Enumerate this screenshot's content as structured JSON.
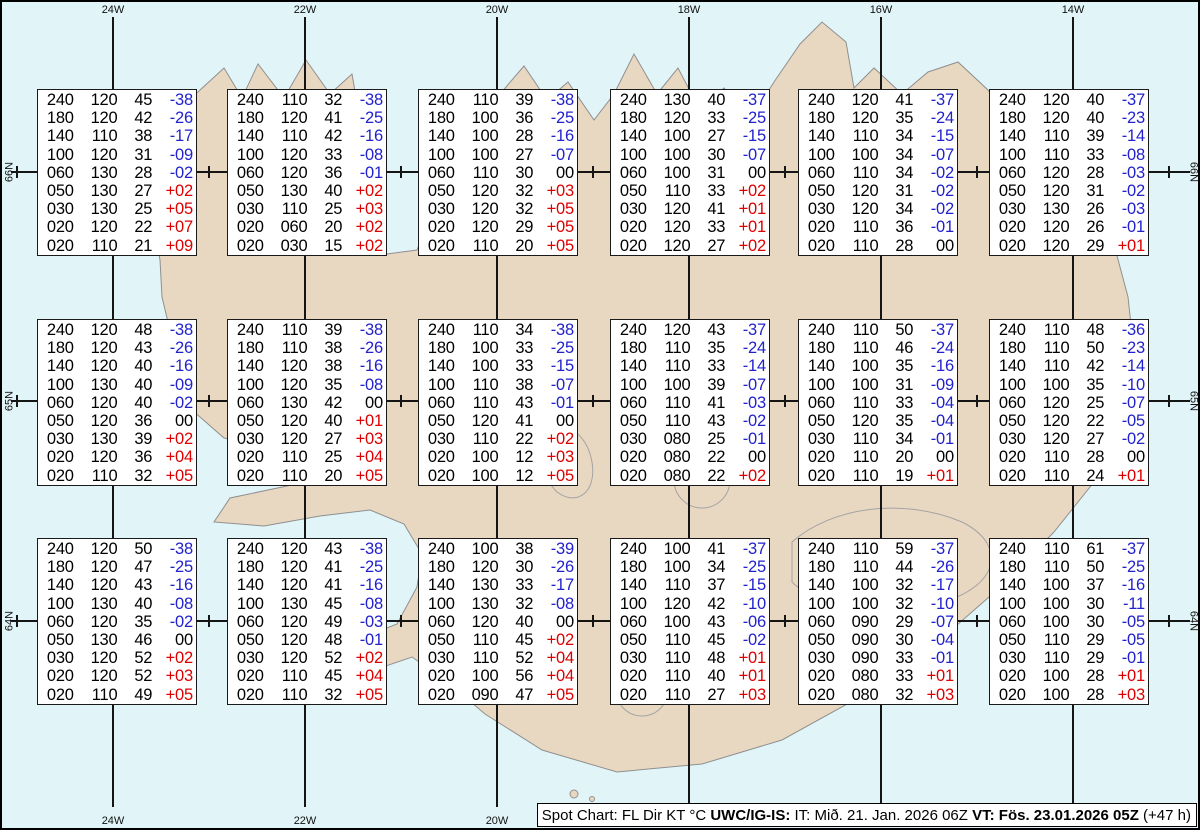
{
  "colors": {
    "water": "#e1f5f9",
    "land": "#e9d8c1",
    "coastline": "#8f8f8f",
    "gridline": "#151515",
    "temp_negative": "#2222cc",
    "temp_positive": "#dd0000",
    "temp_zero": "#000000"
  },
  "axes": {
    "lon_labels": [
      "24W",
      "22W",
      "20W",
      "18W",
      "16W",
      "14W"
    ],
    "lat_labels": [
      "66N",
      "65N",
      "64N"
    ]
  },
  "caption": {
    "segments": [
      {
        "text": "Spot Chart: FL Dir KT °C ",
        "bold": false
      },
      {
        "text": "UWC/IG-IS:",
        "bold": true
      },
      {
        "text": " IT: Mið. 21. Jan. 2026 06Z ",
        "bold": false
      },
      {
        "text": "VT: Fös. 23.01.2026 05Z",
        "bold": true
      },
      {
        "text": " (+47 h)",
        "bold": false
      }
    ]
  },
  "chart_data": {
    "type": "table",
    "title": "Spot Chart: FL Dir KT °C",
    "source": "UWC/IG-IS",
    "issue_time": "IT: Mið. 21. Jan. 2026 06Z",
    "valid_time": "VT: Fös. 23.01.2026 05Z (+47 h)",
    "columns": [
      "FL",
      "Dir",
      "KT",
      "°C"
    ],
    "lon_gridlines": [
      "24W",
      "22W",
      "20W",
      "18W",
      "16W",
      "14W"
    ],
    "lat_gridlines": [
      "66N",
      "65N",
      "64N"
    ],
    "spot_tables": [
      {
        "grid_row": 0,
        "grid_col": 0,
        "rows": [
          [
            "240",
            "120",
            "45",
            "-38"
          ],
          [
            "180",
            "120",
            "42",
            "-26"
          ],
          [
            "140",
            "110",
            "38",
            "-17"
          ],
          [
            "100",
            "120",
            "31",
            "-09"
          ],
          [
            "060",
            "130",
            "28",
            "-02"
          ],
          [
            "050",
            "130",
            "27",
            "+02"
          ],
          [
            "030",
            "130",
            "25",
            "+05"
          ],
          [
            "020",
            "120",
            "22",
            "+07"
          ],
          [
            "020",
            "110",
            "21",
            "+09"
          ]
        ]
      },
      {
        "grid_row": 0,
        "grid_col": 1,
        "rows": [
          [
            "240",
            "110",
            "32",
            "-38"
          ],
          [
            "180",
            "120",
            "41",
            "-25"
          ],
          [
            "140",
            "110",
            "42",
            "-16"
          ],
          [
            "100",
            "120",
            "33",
            "-08"
          ],
          [
            "060",
            "120",
            "36",
            "-01"
          ],
          [
            "050",
            "130",
            "40",
            "+02"
          ],
          [
            "030",
            "110",
            "25",
            "+03"
          ],
          [
            "020",
            "060",
            "20",
            "+02"
          ],
          [
            "020",
            "030",
            "15",
            "+02"
          ]
        ]
      },
      {
        "grid_row": 0,
        "grid_col": 2,
        "rows": [
          [
            "240",
            "110",
            "39",
            "-38"
          ],
          [
            "180",
            "100",
            "36",
            "-25"
          ],
          [
            "140",
            "100",
            "28",
            "-16"
          ],
          [
            "100",
            "100",
            "27",
            "-07"
          ],
          [
            "060",
            "110",
            "30",
            "00"
          ],
          [
            "050",
            "120",
            "32",
            "+03"
          ],
          [
            "030",
            "120",
            "32",
            "+05"
          ],
          [
            "020",
            "120",
            "29",
            "+05"
          ],
          [
            "020",
            "110",
            "20",
            "+05"
          ]
        ]
      },
      {
        "grid_row": 0,
        "grid_col": 3,
        "rows": [
          [
            "240",
            "130",
            "40",
            "-37"
          ],
          [
            "180",
            "120",
            "33",
            "-25"
          ],
          [
            "140",
            "100",
            "27",
            "-15"
          ],
          [
            "100",
            "100",
            "30",
            "-07"
          ],
          [
            "060",
            "100",
            "31",
            "00"
          ],
          [
            "050",
            "110",
            "33",
            "+02"
          ],
          [
            "030",
            "120",
            "41",
            "+01"
          ],
          [
            "020",
            "120",
            "33",
            "+01"
          ],
          [
            "020",
            "120",
            "27",
            "+02"
          ]
        ]
      },
      {
        "grid_row": 0,
        "grid_col": 4,
        "rows": [
          [
            "240",
            "120",
            "41",
            "-37"
          ],
          [
            "180",
            "120",
            "35",
            "-24"
          ],
          [
            "140",
            "110",
            "34",
            "-15"
          ],
          [
            "100",
            "100",
            "34",
            "-07"
          ],
          [
            "060",
            "110",
            "34",
            "-02"
          ],
          [
            "050",
            "120",
            "31",
            "-02"
          ],
          [
            "030",
            "120",
            "34",
            "-02"
          ],
          [
            "020",
            "110",
            "36",
            "-01"
          ],
          [
            "020",
            "110",
            "28",
            "00"
          ]
        ]
      },
      {
        "grid_row": 0,
        "grid_col": 5,
        "rows": [
          [
            "240",
            "120",
            "40",
            "-37"
          ],
          [
            "180",
            "120",
            "40",
            "-23"
          ],
          [
            "140",
            "110",
            "39",
            "-14"
          ],
          [
            "100",
            "110",
            "33",
            "-08"
          ],
          [
            "060",
            "120",
            "28",
            "-03"
          ],
          [
            "050",
            "120",
            "31",
            "-02"
          ],
          [
            "030",
            "130",
            "26",
            "-03"
          ],
          [
            "020",
            "120",
            "26",
            "-01"
          ],
          [
            "020",
            "120",
            "29",
            "+01"
          ]
        ]
      },
      {
        "grid_row": 1,
        "grid_col": 0,
        "rows": [
          [
            "240",
            "120",
            "48",
            "-38"
          ],
          [
            "180",
            "120",
            "43",
            "-26"
          ],
          [
            "140",
            "120",
            "40",
            "-16"
          ],
          [
            "100",
            "130",
            "40",
            "-09"
          ],
          [
            "060",
            "120",
            "40",
            "-02"
          ],
          [
            "050",
            "120",
            "36",
            "00"
          ],
          [
            "030",
            "130",
            "39",
            "+02"
          ],
          [
            "020",
            "120",
            "36",
            "+04"
          ],
          [
            "020",
            "110",
            "32",
            "+05"
          ]
        ]
      },
      {
        "grid_row": 1,
        "grid_col": 1,
        "rows": [
          [
            "240",
            "110",
            "39",
            "-38"
          ],
          [
            "180",
            "110",
            "38",
            "-26"
          ],
          [
            "140",
            "120",
            "38",
            "-16"
          ],
          [
            "100",
            "120",
            "35",
            "-08"
          ],
          [
            "060",
            "130",
            "42",
            "00"
          ],
          [
            "050",
            "120",
            "40",
            "+01"
          ],
          [
            "030",
            "120",
            "27",
            "+03"
          ],
          [
            "020",
            "110",
            "25",
            "+04"
          ],
          [
            "020",
            "110",
            "20",
            "+05"
          ]
        ]
      },
      {
        "grid_row": 1,
        "grid_col": 2,
        "rows": [
          [
            "240",
            "110",
            "34",
            "-38"
          ],
          [
            "180",
            "100",
            "33",
            "-25"
          ],
          [
            "140",
            "100",
            "33",
            "-15"
          ],
          [
            "100",
            "110",
            "38",
            "-07"
          ],
          [
            "060",
            "110",
            "43",
            "-01"
          ],
          [
            "050",
            "120",
            "41",
            "00"
          ],
          [
            "030",
            "110",
            "22",
            "+02"
          ],
          [
            "020",
            "100",
            "12",
            "+03"
          ],
          [
            "020",
            "100",
            "12",
            "+05"
          ]
        ]
      },
      {
        "grid_row": 1,
        "grid_col": 3,
        "rows": [
          [
            "240",
            "120",
            "43",
            "-37"
          ],
          [
            "180",
            "110",
            "35",
            "-24"
          ],
          [
            "140",
            "110",
            "33",
            "-14"
          ],
          [
            "100",
            "100",
            "39",
            "-07"
          ],
          [
            "060",
            "110",
            "41",
            "-03"
          ],
          [
            "050",
            "110",
            "43",
            "-02"
          ],
          [
            "030",
            "080",
            "25",
            "-01"
          ],
          [
            "020",
            "080",
            "22",
            "00"
          ],
          [
            "020",
            "080",
            "22",
            "+02"
          ]
        ]
      },
      {
        "grid_row": 1,
        "grid_col": 4,
        "rows": [
          [
            "240",
            "110",
            "50",
            "-37"
          ],
          [
            "180",
            "110",
            "46",
            "-24"
          ],
          [
            "140",
            "100",
            "35",
            "-16"
          ],
          [
            "100",
            "100",
            "31",
            "-09"
          ],
          [
            "060",
            "110",
            "33",
            "-04"
          ],
          [
            "050",
            "120",
            "35",
            "-04"
          ],
          [
            "030",
            "110",
            "34",
            "-01"
          ],
          [
            "020",
            "110",
            "20",
            "00"
          ],
          [
            "020",
            "110",
            "19",
            "+01"
          ]
        ]
      },
      {
        "grid_row": 1,
        "grid_col": 5,
        "rows": [
          [
            "240",
            "110",
            "48",
            "-36"
          ],
          [
            "180",
            "110",
            "50",
            "-23"
          ],
          [
            "140",
            "110",
            "42",
            "-14"
          ],
          [
            "100",
            "100",
            "35",
            "-10"
          ],
          [
            "060",
            "120",
            "25",
            "-07"
          ],
          [
            "050",
            "120",
            "22",
            "-05"
          ],
          [
            "030",
            "120",
            "27",
            "-02"
          ],
          [
            "020",
            "110",
            "28",
            "00"
          ],
          [
            "020",
            "110",
            "24",
            "+01"
          ]
        ]
      },
      {
        "grid_row": 2,
        "grid_col": 0,
        "rows": [
          [
            "240",
            "120",
            "50",
            "-38"
          ],
          [
            "180",
            "120",
            "47",
            "-25"
          ],
          [
            "140",
            "120",
            "43",
            "-16"
          ],
          [
            "100",
            "130",
            "40",
            "-08"
          ],
          [
            "060",
            "120",
            "35",
            "-02"
          ],
          [
            "050",
            "130",
            "46",
            "00"
          ],
          [
            "030",
            "120",
            "52",
            "+02"
          ],
          [
            "020",
            "120",
            "52",
            "+03"
          ],
          [
            "020",
            "110",
            "49",
            "+05"
          ]
        ]
      },
      {
        "grid_row": 2,
        "grid_col": 1,
        "rows": [
          [
            "240",
            "120",
            "43",
            "-38"
          ],
          [
            "180",
            "120",
            "41",
            "-25"
          ],
          [
            "140",
            "120",
            "41",
            "-16"
          ],
          [
            "100",
            "130",
            "45",
            "-08"
          ],
          [
            "060",
            "120",
            "49",
            "-03"
          ],
          [
            "050",
            "120",
            "48",
            "-01"
          ],
          [
            "030",
            "120",
            "52",
            "+02"
          ],
          [
            "020",
            "110",
            "45",
            "+04"
          ],
          [
            "020",
            "110",
            "32",
            "+05"
          ]
        ]
      },
      {
        "grid_row": 2,
        "grid_col": 2,
        "rows": [
          [
            "240",
            "100",
            "38",
            "-39"
          ],
          [
            "180",
            "120",
            "30",
            "-26"
          ],
          [
            "140",
            "130",
            "33",
            "-17"
          ],
          [
            "100",
            "130",
            "32",
            "-08"
          ],
          [
            "060",
            "120",
            "40",
            "00"
          ],
          [
            "050",
            "110",
            "45",
            "+02"
          ],
          [
            "030",
            "110",
            "52",
            "+04"
          ],
          [
            "020",
            "100",
            "56",
            "+04"
          ],
          [
            "020",
            "090",
            "47",
            "+05"
          ]
        ]
      },
      {
        "grid_row": 2,
        "grid_col": 3,
        "rows": [
          [
            "240",
            "100",
            "41",
            "-37"
          ],
          [
            "180",
            "100",
            "34",
            "-25"
          ],
          [
            "140",
            "110",
            "37",
            "-15"
          ],
          [
            "100",
            "120",
            "42",
            "-10"
          ],
          [
            "060",
            "100",
            "43",
            "-06"
          ],
          [
            "050",
            "110",
            "45",
            "-02"
          ],
          [
            "030",
            "110",
            "48",
            "+01"
          ],
          [
            "020",
            "110",
            "40",
            "+01"
          ],
          [
            "020",
            "110",
            "27",
            "+03"
          ]
        ]
      },
      {
        "grid_row": 2,
        "grid_col": 4,
        "rows": [
          [
            "240",
            "110",
            "59",
            "-37"
          ],
          [
            "180",
            "110",
            "44",
            "-26"
          ],
          [
            "140",
            "100",
            "32",
            "-17"
          ],
          [
            "100",
            "100",
            "32",
            "-10"
          ],
          [
            "060",
            "090",
            "29",
            "-07"
          ],
          [
            "050",
            "090",
            "30",
            "-04"
          ],
          [
            "030",
            "090",
            "33",
            "-01"
          ],
          [
            "020",
            "080",
            "33",
            "+01"
          ],
          [
            "020",
            "080",
            "32",
            "+03"
          ]
        ]
      },
      {
        "grid_row": 2,
        "grid_col": 5,
        "rows": [
          [
            "240",
            "110",
            "61",
            "-37"
          ],
          [
            "180",
            "110",
            "50",
            "-25"
          ],
          [
            "140",
            "100",
            "37",
            "-16"
          ],
          [
            "100",
            "100",
            "30",
            "-11"
          ],
          [
            "060",
            "100",
            "30",
            "-05"
          ],
          [
            "050",
            "110",
            "29",
            "-05"
          ],
          [
            "030",
            "110",
            "29",
            "-01"
          ],
          [
            "020",
            "100",
            "28",
            "+01"
          ],
          [
            "020",
            "100",
            "28",
            "+03"
          ]
        ]
      }
    ]
  }
}
